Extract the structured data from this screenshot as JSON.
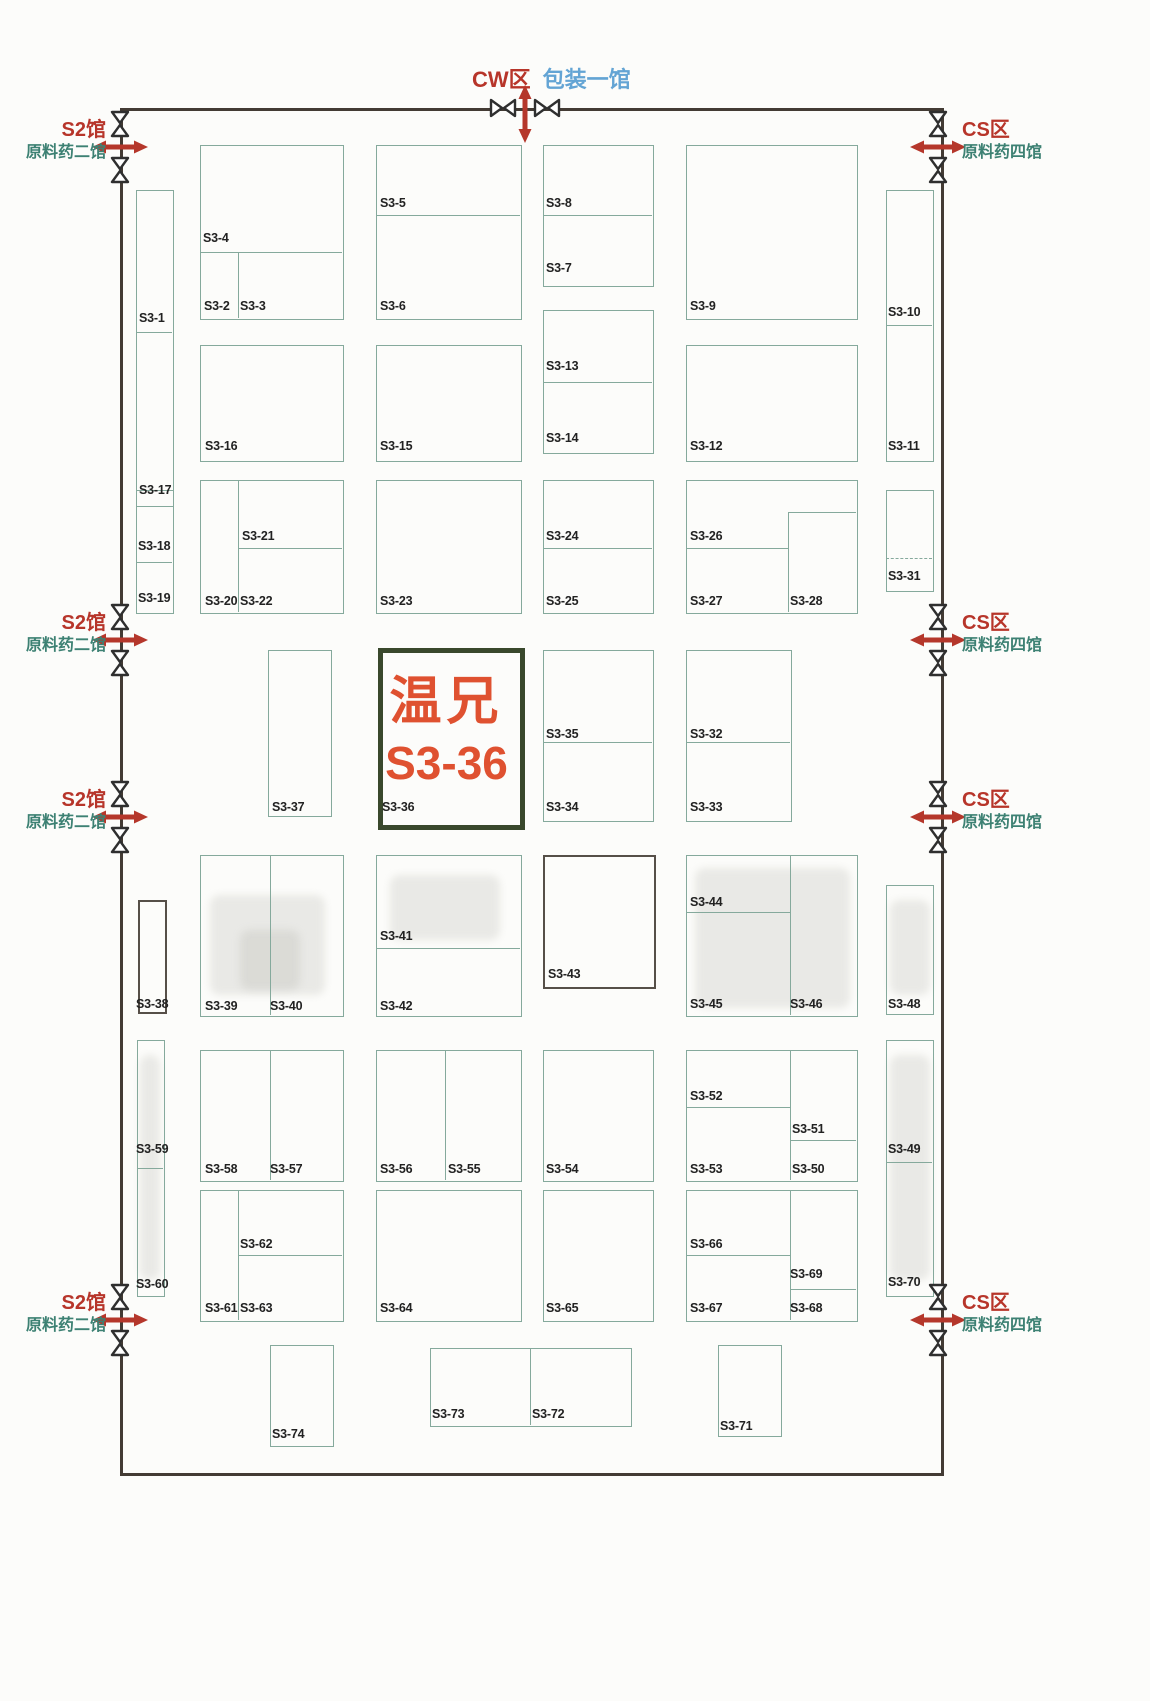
{
  "top_entrance": {
    "zone": "CW区",
    "hall": "包装一馆"
  },
  "left_entrance": {
    "zone": "S2馆",
    "hall": "原料药二馆"
  },
  "right_entrance": {
    "zone": "CS区",
    "hall": "原料药四馆"
  },
  "highlight": {
    "company": "温兄",
    "booth_no": "S3-36"
  },
  "colors": {
    "wall": "#433b34",
    "booth_border": "#85a99c",
    "dark_border": "#564f48",
    "highlight_border": "#39482c",
    "highlight_text": "#df5130",
    "red": "#b7352a",
    "teal": "#3d8173",
    "blue": "#63a4d4",
    "label": "#222222",
    "arrow": "#b5372b"
  },
  "map": {
    "wall": {
      "x": 120,
      "y": 108,
      "w": 818,
      "h": 1362
    },
    "boxes": [
      [
        136,
        190,
        36,
        315
      ],
      [
        886,
        190,
        46,
        270
      ],
      [
        200,
        145,
        142,
        173
      ],
      [
        376,
        145,
        144,
        173
      ],
      [
        543,
        145,
        109,
        140
      ],
      [
        686,
        145,
        170,
        173
      ],
      [
        200,
        345,
        142,
        115
      ],
      [
        376,
        345,
        144,
        115
      ],
      [
        543,
        310,
        109,
        142
      ],
      [
        686,
        345,
        170,
        115
      ],
      [
        136,
        490,
        36,
        122
      ],
      [
        886,
        490,
        46,
        100
      ],
      [
        200,
        480,
        142,
        132
      ],
      [
        376,
        480,
        144,
        132
      ],
      [
        543,
        480,
        109,
        132
      ],
      [
        686,
        480,
        170,
        132
      ],
      [
        268,
        650,
        62,
        165
      ],
      [
        378,
        648,
        137,
        172,
        "highlight",
        "highlight-booth-s3-36"
      ],
      [
        543,
        650,
        109,
        170
      ],
      [
        686,
        650,
        104,
        170
      ],
      [
        138,
        900,
        25,
        110,
        "dark"
      ],
      [
        886,
        885,
        46,
        128
      ],
      [
        200,
        855,
        142,
        160
      ],
      [
        376,
        855,
        144,
        160
      ],
      [
        543,
        855,
        109,
        130,
        "dark"
      ],
      [
        686,
        855,
        170,
        160
      ],
      [
        137,
        1040,
        26,
        255
      ],
      [
        886,
        1040,
        46,
        255
      ],
      [
        200,
        1050,
        142,
        130
      ],
      [
        376,
        1050,
        144,
        130
      ],
      [
        543,
        1050,
        109,
        130
      ],
      [
        686,
        1050,
        170,
        130
      ],
      [
        200,
        1190,
        142,
        130
      ],
      [
        376,
        1190,
        144,
        130
      ],
      [
        543,
        1190,
        109,
        130
      ],
      [
        686,
        1190,
        170,
        130
      ],
      [
        270,
        1345,
        62,
        100
      ],
      [
        430,
        1348,
        200,
        77
      ],
      [
        718,
        1345,
        62,
        90
      ]
    ],
    "dividers": [
      [
        "h",
        136,
        332,
        36
      ],
      [
        "h",
        886,
        325,
        46
      ],
      [
        "h",
        200,
        252,
        142
      ],
      [
        "v",
        238,
        252,
        66
      ],
      [
        "h",
        376,
        215,
        144
      ],
      [
        "h",
        543,
        215,
        109
      ],
      [
        "h",
        543,
        382,
        109
      ],
      [
        "v",
        238,
        480,
        132
      ],
      [
        "h",
        238,
        548,
        104
      ],
      [
        "h",
        543,
        548,
        109
      ],
      [
        "v",
        788,
        512,
        100
      ],
      [
        "h",
        788,
        512,
        68
      ],
      [
        "h",
        686,
        548,
        102
      ],
      [
        "h",
        136,
        562,
        36
      ],
      [
        "h",
        886,
        558,
        46,
        1
      ],
      [
        "h",
        543,
        742,
        109
      ],
      [
        "h",
        686,
        742,
        104
      ],
      [
        "v",
        270,
        855,
        160
      ],
      [
        "h",
        376,
        948,
        144
      ],
      [
        "v",
        790,
        855,
        160
      ],
      [
        "h",
        686,
        912,
        104
      ],
      [
        "h",
        137,
        1168,
        26
      ],
      [
        "h",
        886,
        1162,
        46
      ],
      [
        "v",
        270,
        1050,
        130
      ],
      [
        "v",
        445,
        1050,
        130
      ],
      [
        "v",
        790,
        1050,
        130
      ],
      [
        "h",
        686,
        1107,
        104
      ],
      [
        "h",
        790,
        1140,
        66
      ],
      [
        "v",
        238,
        1190,
        130
      ],
      [
        "h",
        238,
        1255,
        104
      ],
      [
        "v",
        790,
        1190,
        130
      ],
      [
        "h",
        686,
        1255,
        104
      ],
      [
        "h",
        790,
        1289,
        66
      ],
      [
        "v",
        530,
        1348,
        77
      ]
    ],
    "labels": [
      [
        "S3-1",
        139,
        312
      ],
      [
        "S3-17",
        139,
        484
      ],
      [
        "S3-18",
        138,
        540
      ],
      [
        "S3-19",
        138,
        592
      ],
      [
        "S3-4",
        203,
        232
      ],
      [
        "S3-2",
        204,
        300
      ],
      [
        "S3-3",
        240,
        300
      ],
      [
        "S3-5",
        380,
        197
      ],
      [
        "S3-6",
        380,
        300
      ],
      [
        "S3-8",
        546,
        197
      ],
      [
        "S3-7",
        546,
        262
      ],
      [
        "S3-9",
        690,
        300
      ],
      [
        "S3-10",
        888,
        306
      ],
      [
        "S3-11",
        888,
        440
      ],
      [
        "S3-31",
        888,
        570
      ],
      [
        "S3-16",
        205,
        440
      ],
      [
        "S3-15",
        380,
        440
      ],
      [
        "S3-13",
        546,
        360
      ],
      [
        "S3-14",
        546,
        432
      ],
      [
        "S3-12",
        690,
        440
      ],
      [
        "S3-21",
        242,
        530
      ],
      [
        "S3-20",
        205,
        595
      ],
      [
        "S3-22",
        240,
        595
      ],
      [
        "S3-23",
        380,
        595
      ],
      [
        "S3-24",
        546,
        530
      ],
      [
        "S3-25",
        546,
        595
      ],
      [
        "S3-26",
        690,
        530
      ],
      [
        "S3-27",
        690,
        595
      ],
      [
        "S3-28",
        790,
        595
      ],
      [
        "S3-37",
        272,
        801
      ],
      [
        "S3-36",
        382,
        801
      ],
      [
        "S3-35",
        546,
        728
      ],
      [
        "S3-34",
        546,
        801
      ],
      [
        "S3-32",
        690,
        728
      ],
      [
        "S3-33",
        690,
        801
      ],
      [
        "S3-38",
        136,
        998
      ],
      [
        "S3-39",
        205,
        1000
      ],
      [
        "S3-40",
        270,
        1000
      ],
      [
        "S3-41",
        380,
        930
      ],
      [
        "S3-42",
        380,
        1000
      ],
      [
        "S3-43",
        548,
        968
      ],
      [
        "S3-44",
        690,
        896
      ],
      [
        "S3-45",
        690,
        998
      ],
      [
        "S3-46",
        790,
        998
      ],
      [
        "S3-48",
        888,
        998
      ],
      [
        "S3-59",
        136,
        1143
      ],
      [
        "S3-60",
        136,
        1278
      ],
      [
        "S3-49",
        888,
        1143
      ],
      [
        "S3-70",
        888,
        1276
      ],
      [
        "S3-58",
        205,
        1163
      ],
      [
        "S3-57",
        270,
        1163
      ],
      [
        "S3-56",
        380,
        1163
      ],
      [
        "S3-55",
        448,
        1163
      ],
      [
        "S3-54",
        546,
        1163
      ],
      [
        "S3-52",
        690,
        1090
      ],
      [
        "S3-51",
        792,
        1123
      ],
      [
        "S3-53",
        690,
        1163
      ],
      [
        "S3-50",
        792,
        1163
      ],
      [
        "S3-62",
        240,
        1238
      ],
      [
        "S3-61",
        205,
        1302
      ],
      [
        "S3-63",
        240,
        1302
      ],
      [
        "S3-64",
        380,
        1302
      ],
      [
        "S3-65",
        546,
        1302
      ],
      [
        "S3-66",
        690,
        1238
      ],
      [
        "S3-69",
        790,
        1268
      ],
      [
        "S3-67",
        690,
        1302
      ],
      [
        "S3-68",
        790,
        1302
      ],
      [
        "S3-73",
        432,
        1408
      ],
      [
        "S3-72",
        532,
        1408
      ],
      [
        "S3-74",
        272,
        1428
      ],
      [
        "S3-71",
        720,
        1420
      ]
    ],
    "entrances": [
      {
        "side": "left",
        "y": 147
      },
      {
        "side": "left",
        "y": 640
      },
      {
        "side": "left",
        "y": 817
      },
      {
        "side": "left",
        "y": 1320
      },
      {
        "side": "right",
        "y": 147
      },
      {
        "side": "right",
        "y": 640
      },
      {
        "side": "right",
        "y": 817
      },
      {
        "side": "right",
        "y": 1320
      },
      {
        "side": "top",
        "x": 525
      }
    ],
    "smudges": [
      [
        210,
        895,
        115,
        100
      ],
      [
        695,
        868,
        155,
        140
      ],
      [
        890,
        900,
        40,
        95
      ],
      [
        890,
        1055,
        40,
        225
      ],
      [
        140,
        1055,
        20,
        225
      ],
      [
        390,
        875,
        110,
        65
      ],
      [
        240,
        930,
        60,
        60
      ]
    ]
  }
}
